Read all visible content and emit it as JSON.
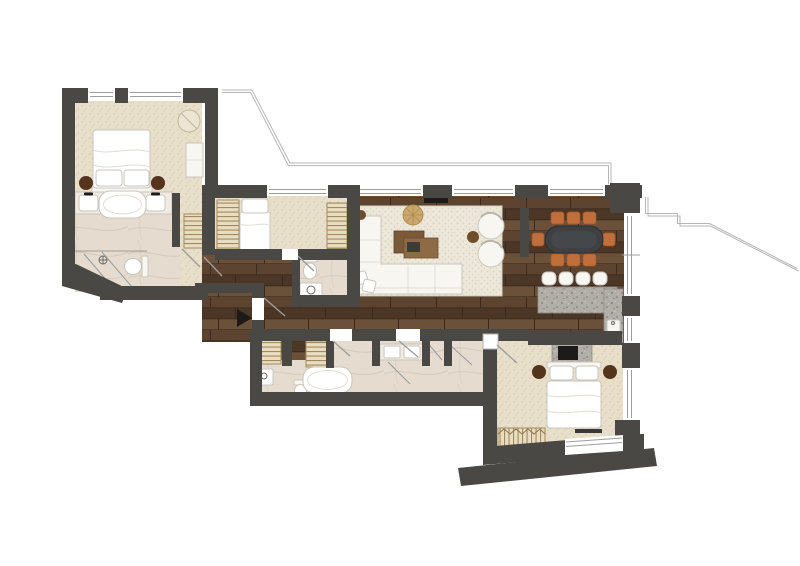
{
  "page": {
    "kind": "apartment-floor-plan",
    "background": "#ffffff"
  },
  "colors": {
    "bg": "#ffffff",
    "wall": "#4a4845",
    "line-thin": "#9d9d9d",
    "terrace-line": "#b6b6b6",
    "wood-a": "#5d4430",
    "wood-b": "#4c3726",
    "wood-c": "#6b513a",
    "wood-joint": "#382a1e",
    "carpet": "#e8dfca",
    "carpet-dot": "#d5c8ac",
    "marble": "#e5dccf",
    "marble-vein": "#cfc2b0",
    "rug": "#ece7d9",
    "rug-dot": "#d9d1bd",
    "granite": "#b1aea8",
    "granite-dot": "#7b7772",
    "closet": "#e9ddc1",
    "closet-line": "#a18a5f",
    "furn-white": "#f7f6f1",
    "furn-stroke": "#c9c5bd",
    "furn-seam": "#e0ddd5",
    "counter-light": "#f0ebe2",
    "accent-chair": "#c06f3c",
    "accent-chair-dark": "#a25827",
    "table-dark": "#3e4043",
    "wood-brown": "#7c5a39",
    "wood-brown-light": "#8d6b47",
    "nightstand": "#54341d",
    "pouf": "#c9a76d",
    "pouf-line": "#ae8d53",
    "black": "#1c1b1a"
  },
  "rooms": [
    {
      "name": "master-bedroom",
      "furniture": [
        "double-bed",
        "pillow",
        "pillow",
        "nightstand",
        "nightstand",
        "round-armchair",
        "desk"
      ]
    },
    {
      "name": "master-bathroom",
      "furniture": [
        "vanity-counter",
        "sink",
        "sink",
        "bathtub",
        "toilet",
        "walk-in-shower"
      ]
    },
    {
      "name": "dressing-passage",
      "furniture": [
        "wardrobe"
      ]
    },
    {
      "name": "second-bedroom",
      "furniture": [
        "single-bed",
        "wardrobe",
        "wardrobe"
      ]
    },
    {
      "name": "powder-room",
      "furniture": [
        "toilet",
        "sink"
      ]
    },
    {
      "name": "hallway",
      "furniture": [
        "entrance-arrow",
        "wardrobe",
        "wardrobe"
      ]
    },
    {
      "name": "living-room",
      "furniture": [
        "area-rug",
        "corner-sofa",
        "throw-pillow",
        "throw-pillow",
        "coffee-table",
        "coffee-table",
        "tray",
        "pouf",
        "round-armchair",
        "round-armchair",
        "side-table",
        "side-table",
        "wall-tv"
      ]
    },
    {
      "name": "dining-area",
      "furniture": [
        "oval-table",
        "dining-chair",
        "dining-chair",
        "dining-chair",
        "dining-chair",
        "dining-chair",
        "dining-chair",
        "dining-chair",
        "dining-chair"
      ]
    },
    {
      "name": "kitchen",
      "furniture": [
        "island-counter",
        "bar-stool",
        "bar-stool",
        "bar-stool",
        "bar-stool",
        "counter",
        "sink",
        "cooktop-unit"
      ]
    },
    {
      "name": "guest-bathroom",
      "furniture": [
        "double-vanity",
        "sink",
        "sink",
        "bathtub",
        "toilet",
        "hand-sink",
        "shower"
      ]
    },
    {
      "name": "third-bedroom",
      "furniture": [
        "double-bed",
        "nightstand",
        "nightstand",
        "bench",
        "dresser"
      ]
    }
  ],
  "outdoor": {
    "terrace_outline": true,
    "entrance_marker": "black-arrow"
  }
}
